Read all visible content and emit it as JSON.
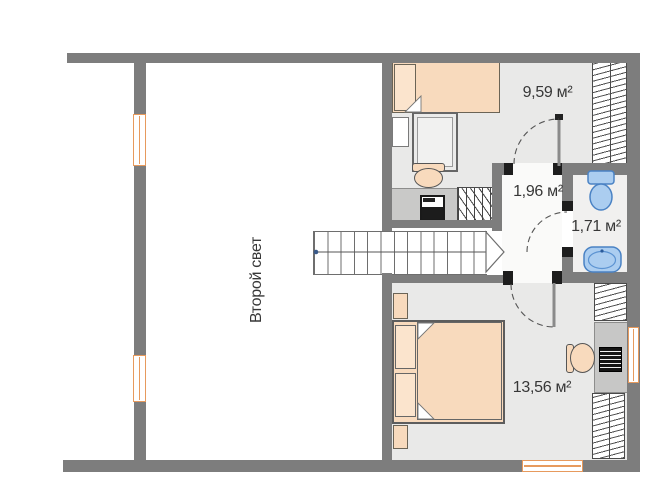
{
  "floorplan": {
    "void_room": {
      "label": "Второй свет"
    },
    "bedroom_top": {
      "area": "9,59 м²"
    },
    "hallway": {
      "area": "1,96 м²"
    },
    "bathroom": {
      "area": "1,71 м²"
    },
    "bedroom_bottom": {
      "area": "13,56 м²"
    },
    "colors": {
      "wall": "#7d7d7d",
      "door_jamb": "#1d1d1d",
      "room_floor": "#e9e9e8",
      "furniture_fill": "#f8dabd",
      "window_frame": "#e79a5d",
      "sanitary_fill": "#abcdf0",
      "sanitary_outline": "#4a82c4",
      "label_text": "#373737"
    }
  }
}
